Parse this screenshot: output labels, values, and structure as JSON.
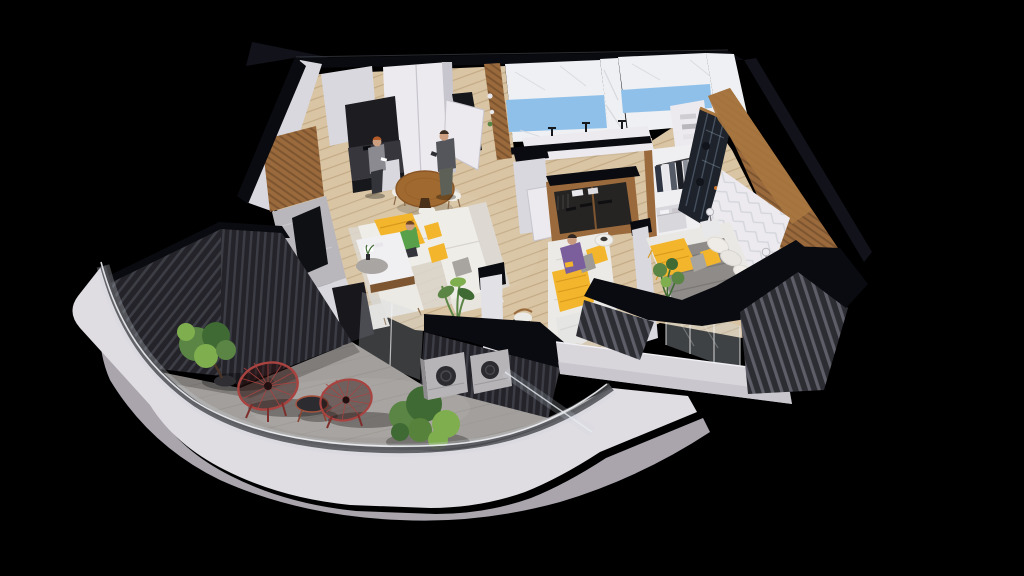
{
  "palette": {
    "background": "#000000",
    "roof-shadow": "#11121a",
    "wall-top": "#0a0b10",
    "wall-face": "#d9d8de",
    "wall-bright": "#eceaee",
    "wall-shade": "#c7c5cd",
    "wood": "#9a6a3c",
    "wood-dark": "#7d5530",
    "wood-light": "#a9773f",
    "floor-wood": "#d9c4a4",
    "floor-line": "#c3ab85",
    "marble": "#eef0f3",
    "marble-vein": "#d3d6dc",
    "tile-blue": "#8fc0ea",
    "slat-dark": "#232329",
    "slat-stripe": "#3d3d46",
    "slat-grey": "#2c2c33",
    "slat-grey-stripe": "#5e5e68",
    "concrete": "#a39f9c",
    "concrete-line": "#938f8c",
    "slab": "#dfdce2",
    "slab-side": "#aaa5ad",
    "glass": "#cfd9e0",
    "sofa": "#efede8",
    "sofa-shade": "#ddd9d2",
    "accent-yellow": "#f2b52c",
    "yellow-deep": "#d8991c",
    "blanket-grey": "#8e8b88",
    "pillow-grey": "#a8a5a1",
    "tv-screen": "#0e1014",
    "counter-dark": "#36363c",
    "counter-front": "#17181c",
    "table-wood": "#a0692f",
    "chair-red": "#a84340",
    "chair-red-dark": "#7e2f2c",
    "leaf-dark": "#3f6a33",
    "leaf-mid": "#5a8544",
    "leaf-bright": "#7fae4e",
    "pot-dark": "#2e2e33",
    "skin": "#cc9f80",
    "hair-red": "#b55c2b",
    "hair-brown": "#6f4522",
    "shirt-grey": "#8b8a90",
    "pants-dark": "#33343a",
    "hoodie-green": "#58a14a",
    "shirt-purple": "#7b5f9d",
    "metal-grey": "#b7b4b7",
    "fan-dark": "#2b2b30",
    "wardrobe-glass": "#1d222b"
  },
  "scene": {
    "type": "isometric-cutaway-apartment-render",
    "people_count": 4,
    "rooms": [
      {
        "name": "kitchen-dining",
        "items": [
          "dark-kitchen-counter",
          "tall-white-cabinets",
          "round-wood-dining-table",
          "four-white-chairs",
          "woman-cooking"
        ]
      },
      {
        "name": "entry-hall",
        "items": [
          "white-wardrobe-block",
          "open-entry-door",
          "man-standing-with-phone",
          "wood-shelf-pillar"
        ]
      },
      {
        "name": "living-room",
        "items": [
          "white-corner-sofa",
          "yellow-throw",
          "yellow-pillows",
          "child-sitting",
          "coffee-table",
          "round-grey-rug",
          "ottomans",
          "tv-marble-wall",
          "wood-panel",
          "palm-plant"
        ]
      },
      {
        "name": "bathroom-1",
        "items": [
          "marble-wall",
          "blue-tile-band",
          "vanity-sink",
          "black-faucets"
        ]
      },
      {
        "name": "bathroom-2",
        "items": [
          "marble-wall",
          "blue-tile-band",
          "vanity-sink",
          "towel-niche"
        ]
      },
      {
        "name": "study-bedroom",
        "items": [
          "open-wood-wardrobe",
          "white-door-panels",
          "daybed",
          "yellow-blanket",
          "woman-reading",
          "rolled-duvet",
          "wood-chair"
        ]
      },
      {
        "name": "walk-in-closet",
        "items": [
          "hanging-clothes",
          "shelf-stacks",
          "drawer-unit"
        ]
      },
      {
        "name": "master-bedroom",
        "items": [
          "dark-glass-wardrobe",
          "wood-slat-wall",
          "chevron-accent-wall",
          "double-bed",
          "grey-blanket",
          "yellow-throw",
          "yellow-pillow",
          "white-pillows",
          "nightstands",
          "table-lamps",
          "vanity-desk",
          "white-desk-chair",
          "potted-plant",
          "glass-doors"
        ]
      },
      {
        "name": "terrace",
        "items": [
          "slatted-parapet-wall",
          "concrete-floor",
          "potted-tree",
          "acapulco-chair-left",
          "acapulco-chair-right",
          "round-side-table",
          "green-shrubs",
          "ac-unit-left",
          "ac-unit-right",
          "glass-railing"
        ]
      },
      {
        "name": "balcony",
        "items": [
          "black-wall-caps",
          "grey-slat-walls",
          "white-fascia-band"
        ]
      },
      {
        "name": "building-base",
        "items": [
          "white-curved-slab"
        ]
      }
    ]
  }
}
